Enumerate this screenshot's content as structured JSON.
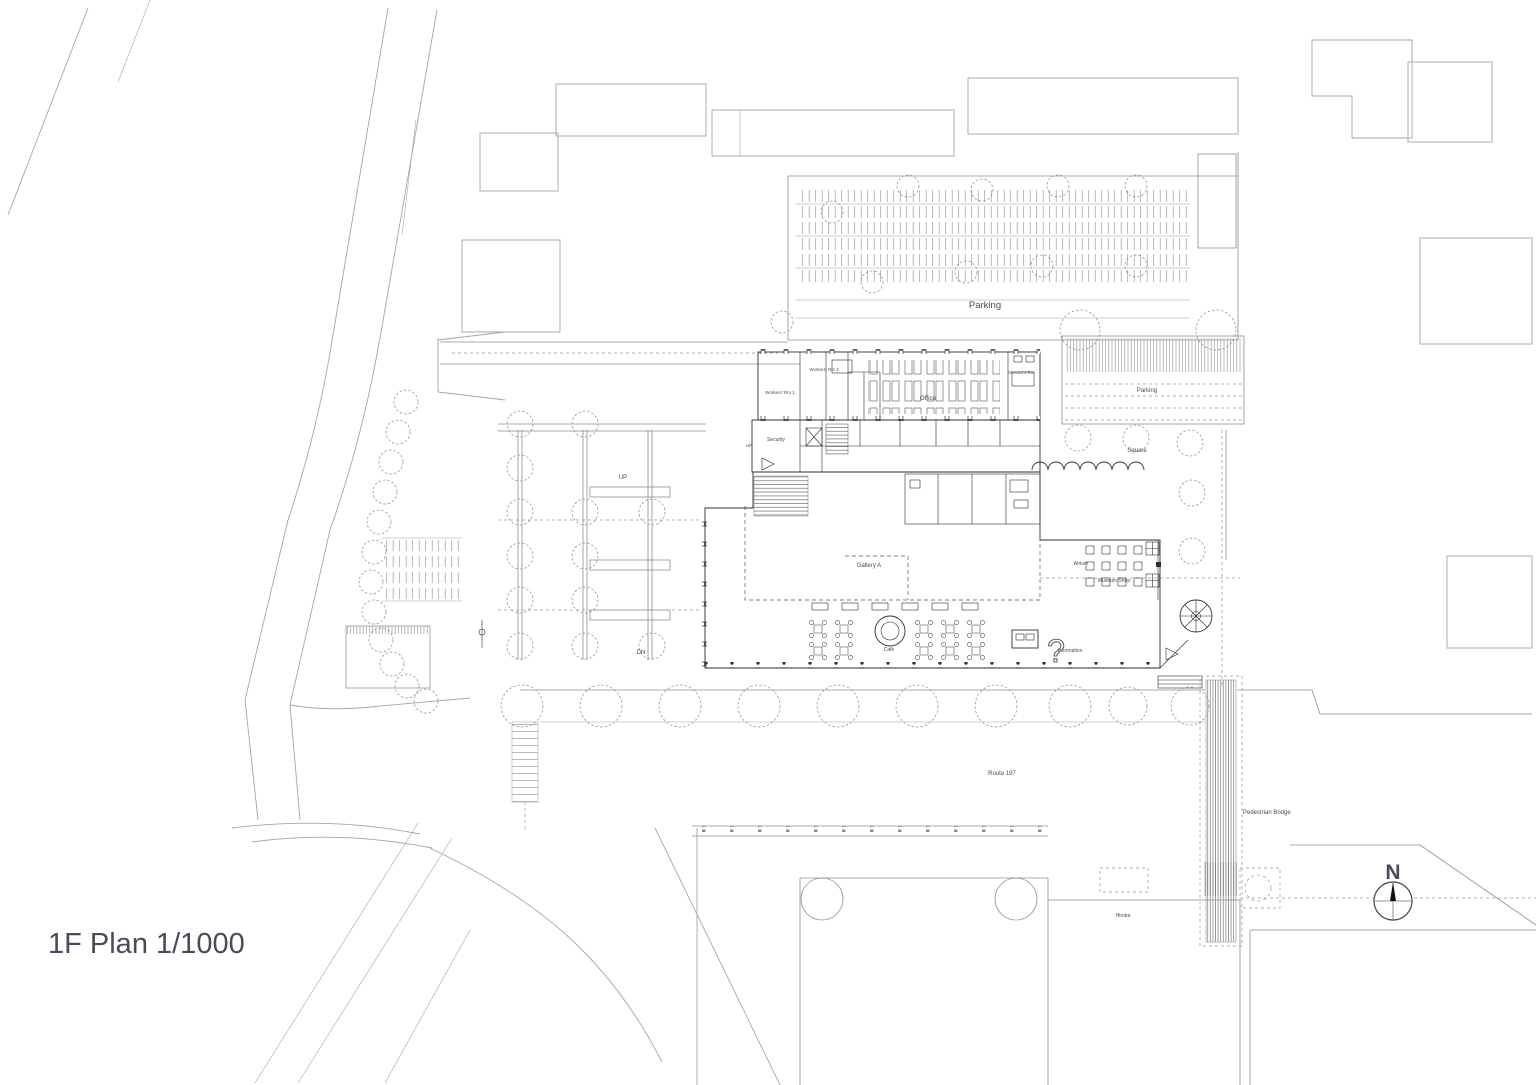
{
  "drawing": {
    "title": "1F Plan 1/1000",
    "type": "architectural site plan, first floor",
    "scale": "1/1000",
    "compass": "N"
  },
  "colors": {
    "ink": "#2f2f2f",
    "context": "#a6a6a6",
    "label": "#4a4a5a",
    "background": "#ffffff"
  },
  "labels": [
    {
      "id": "plan-title",
      "text": "1F Plan 1/1000",
      "x": 48,
      "y": 953,
      "size": 29,
      "anchor": "start",
      "weight": "normal",
      "color": "#161616"
    },
    {
      "id": "north-letter",
      "text": "N",
      "x": 1393,
      "y": 879,
      "size": 21,
      "anchor": "middle",
      "weight": "bold",
      "color": "#1c1c1c"
    },
    {
      "id": "parking-lot",
      "text": "Parking",
      "x": 985,
      "y": 308,
      "size": 9.5,
      "anchor": "middle"
    },
    {
      "id": "parking-roof",
      "text": "Parking",
      "x": 1147,
      "y": 392,
      "size": 6,
      "anchor": "middle"
    },
    {
      "id": "square",
      "text": "Square",
      "x": 1137,
      "y": 452,
      "size": 6,
      "anchor": "middle"
    },
    {
      "id": "office",
      "text": "Office",
      "x": 928,
      "y": 400,
      "size": 6.5,
      "anchor": "middle"
    },
    {
      "id": "workers-rm-1",
      "text": "Workers' Rm 1",
      "x": 780,
      "y": 394,
      "size": 4.5,
      "anchor": "middle"
    },
    {
      "id": "workers-rm-2",
      "text": "Workers' Rm 2",
      "x": 824,
      "y": 371,
      "size": 4.5,
      "anchor": "middle"
    },
    {
      "id": "directors-rm",
      "text": "Director's Rm",
      "x": 1021,
      "y": 374,
      "size": 4.5,
      "anchor": "middle"
    },
    {
      "id": "security",
      "text": "Security",
      "x": 776,
      "y": 441,
      "size": 5,
      "anchor": "middle"
    },
    {
      "id": "gallery-a",
      "text": "Gallery A",
      "x": 869,
      "y": 567,
      "size": 6,
      "anchor": "middle"
    },
    {
      "id": "atrium",
      "text": "Atrium",
      "x": 1081,
      "y": 565,
      "size": 5,
      "anchor": "middle"
    },
    {
      "id": "museum-shop",
      "text": "Museum Shop",
      "x": 1114,
      "y": 582,
      "size": 5,
      "anchor": "middle"
    },
    {
      "id": "cafe",
      "text": "Café",
      "x": 889,
      "y": 651,
      "size": 5,
      "anchor": "middle"
    },
    {
      "id": "information",
      "text": "Information",
      "x": 1070,
      "y": 652,
      "size": 5,
      "anchor": "middle"
    },
    {
      "id": "route-197",
      "text": "Route 197",
      "x": 1002,
      "y": 775,
      "size": 6,
      "anchor": "middle"
    },
    {
      "id": "pedestrian-bridge",
      "text": "Pedestrian Bridge",
      "x": 1243,
      "y": 814,
      "size": 6,
      "anchor": "start"
    },
    {
      "id": "hiroba",
      "text": "Hiroba",
      "x": 1123,
      "y": 917,
      "size": 5,
      "anchor": "middle"
    },
    {
      "id": "up-ramp",
      "text": "UP",
      "x": 623,
      "y": 479,
      "size": 6,
      "anchor": "middle"
    },
    {
      "id": "dn-ramp",
      "text": "DN",
      "x": 641,
      "y": 654,
      "size": 6,
      "anchor": "middle"
    },
    {
      "id": "up-stair",
      "text": "UP",
      "x": 749,
      "y": 447,
      "size": 4.5,
      "anchor": "middle"
    },
    {
      "id": "question-object",
      "text": "?",
      "x": 1056,
      "y": 662,
      "size": 32,
      "anchor": "middle",
      "cls": "outline"
    }
  ]
}
